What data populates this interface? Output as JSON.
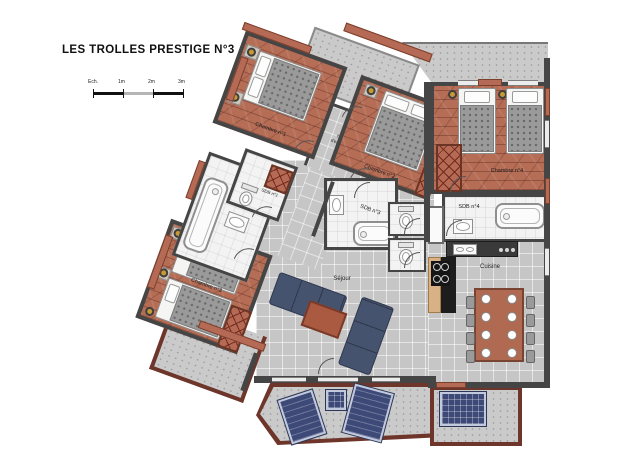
{
  "title": "LES TROLLES PRESTIGE N°3",
  "scale_bar": {
    "label": "Ech.",
    "t1": "1m",
    "t2": "2m",
    "t3": "3m"
  },
  "rooms": {
    "chambre1": "Chambre n°1",
    "chambre2": "Chambre n°2",
    "chambre3": "Chambre n°3",
    "chambre4": "Chambre n°4",
    "sdb1": "SDB n°1",
    "sdb2": "SDB n°2",
    "sdb3": "SDB n°3",
    "sdb4": "SDB n°4",
    "hall_line1": "hall",
    "hall_line2": "d'entrée",
    "sejour": "Séjour",
    "cuisine": "Cuisine"
  },
  "colors": {
    "wood_floor": "#b56d56",
    "walls": "#454545",
    "tile_floor": "#c6c6c6",
    "bathroom_floor": "#f3f3f3",
    "balcony_wall": "#6e352a",
    "terracotta_accent": "#b46a55",
    "sofa": "#46536e",
    "lounger": "#3d4a78",
    "lamp": "#c89a33"
  }
}
